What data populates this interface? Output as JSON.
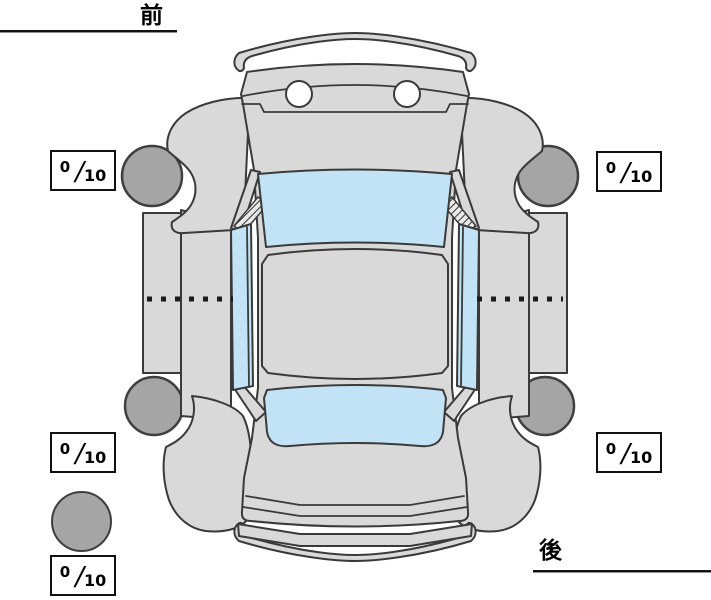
{
  "diagram": {
    "type": "vehicle-condition-top-view",
    "orientation_labels": {
      "front": "前",
      "rear": "後"
    },
    "rating_separator": "/",
    "tire_ratings": {
      "front_left": {
        "value": "0",
        "max": "10"
      },
      "front_right": {
        "value": "0",
        "max": "10"
      },
      "rear_left": {
        "value": "0",
        "max": "10"
      },
      "rear_right": {
        "value": "0",
        "max": "10"
      },
      "spare": {
        "value": "0",
        "max": "10"
      }
    },
    "colors": {
      "background": "#ffffff",
      "body": "#d9d9d9",
      "glass": "#c2e3f5",
      "tire": "#a5a5a5",
      "outline": "#3a3a3a",
      "text": "#000000"
    },
    "icons": {
      "car": "car-top-view-doors-open",
      "tire": "gray-circle",
      "spare_tire": "gray-circle"
    }
  }
}
